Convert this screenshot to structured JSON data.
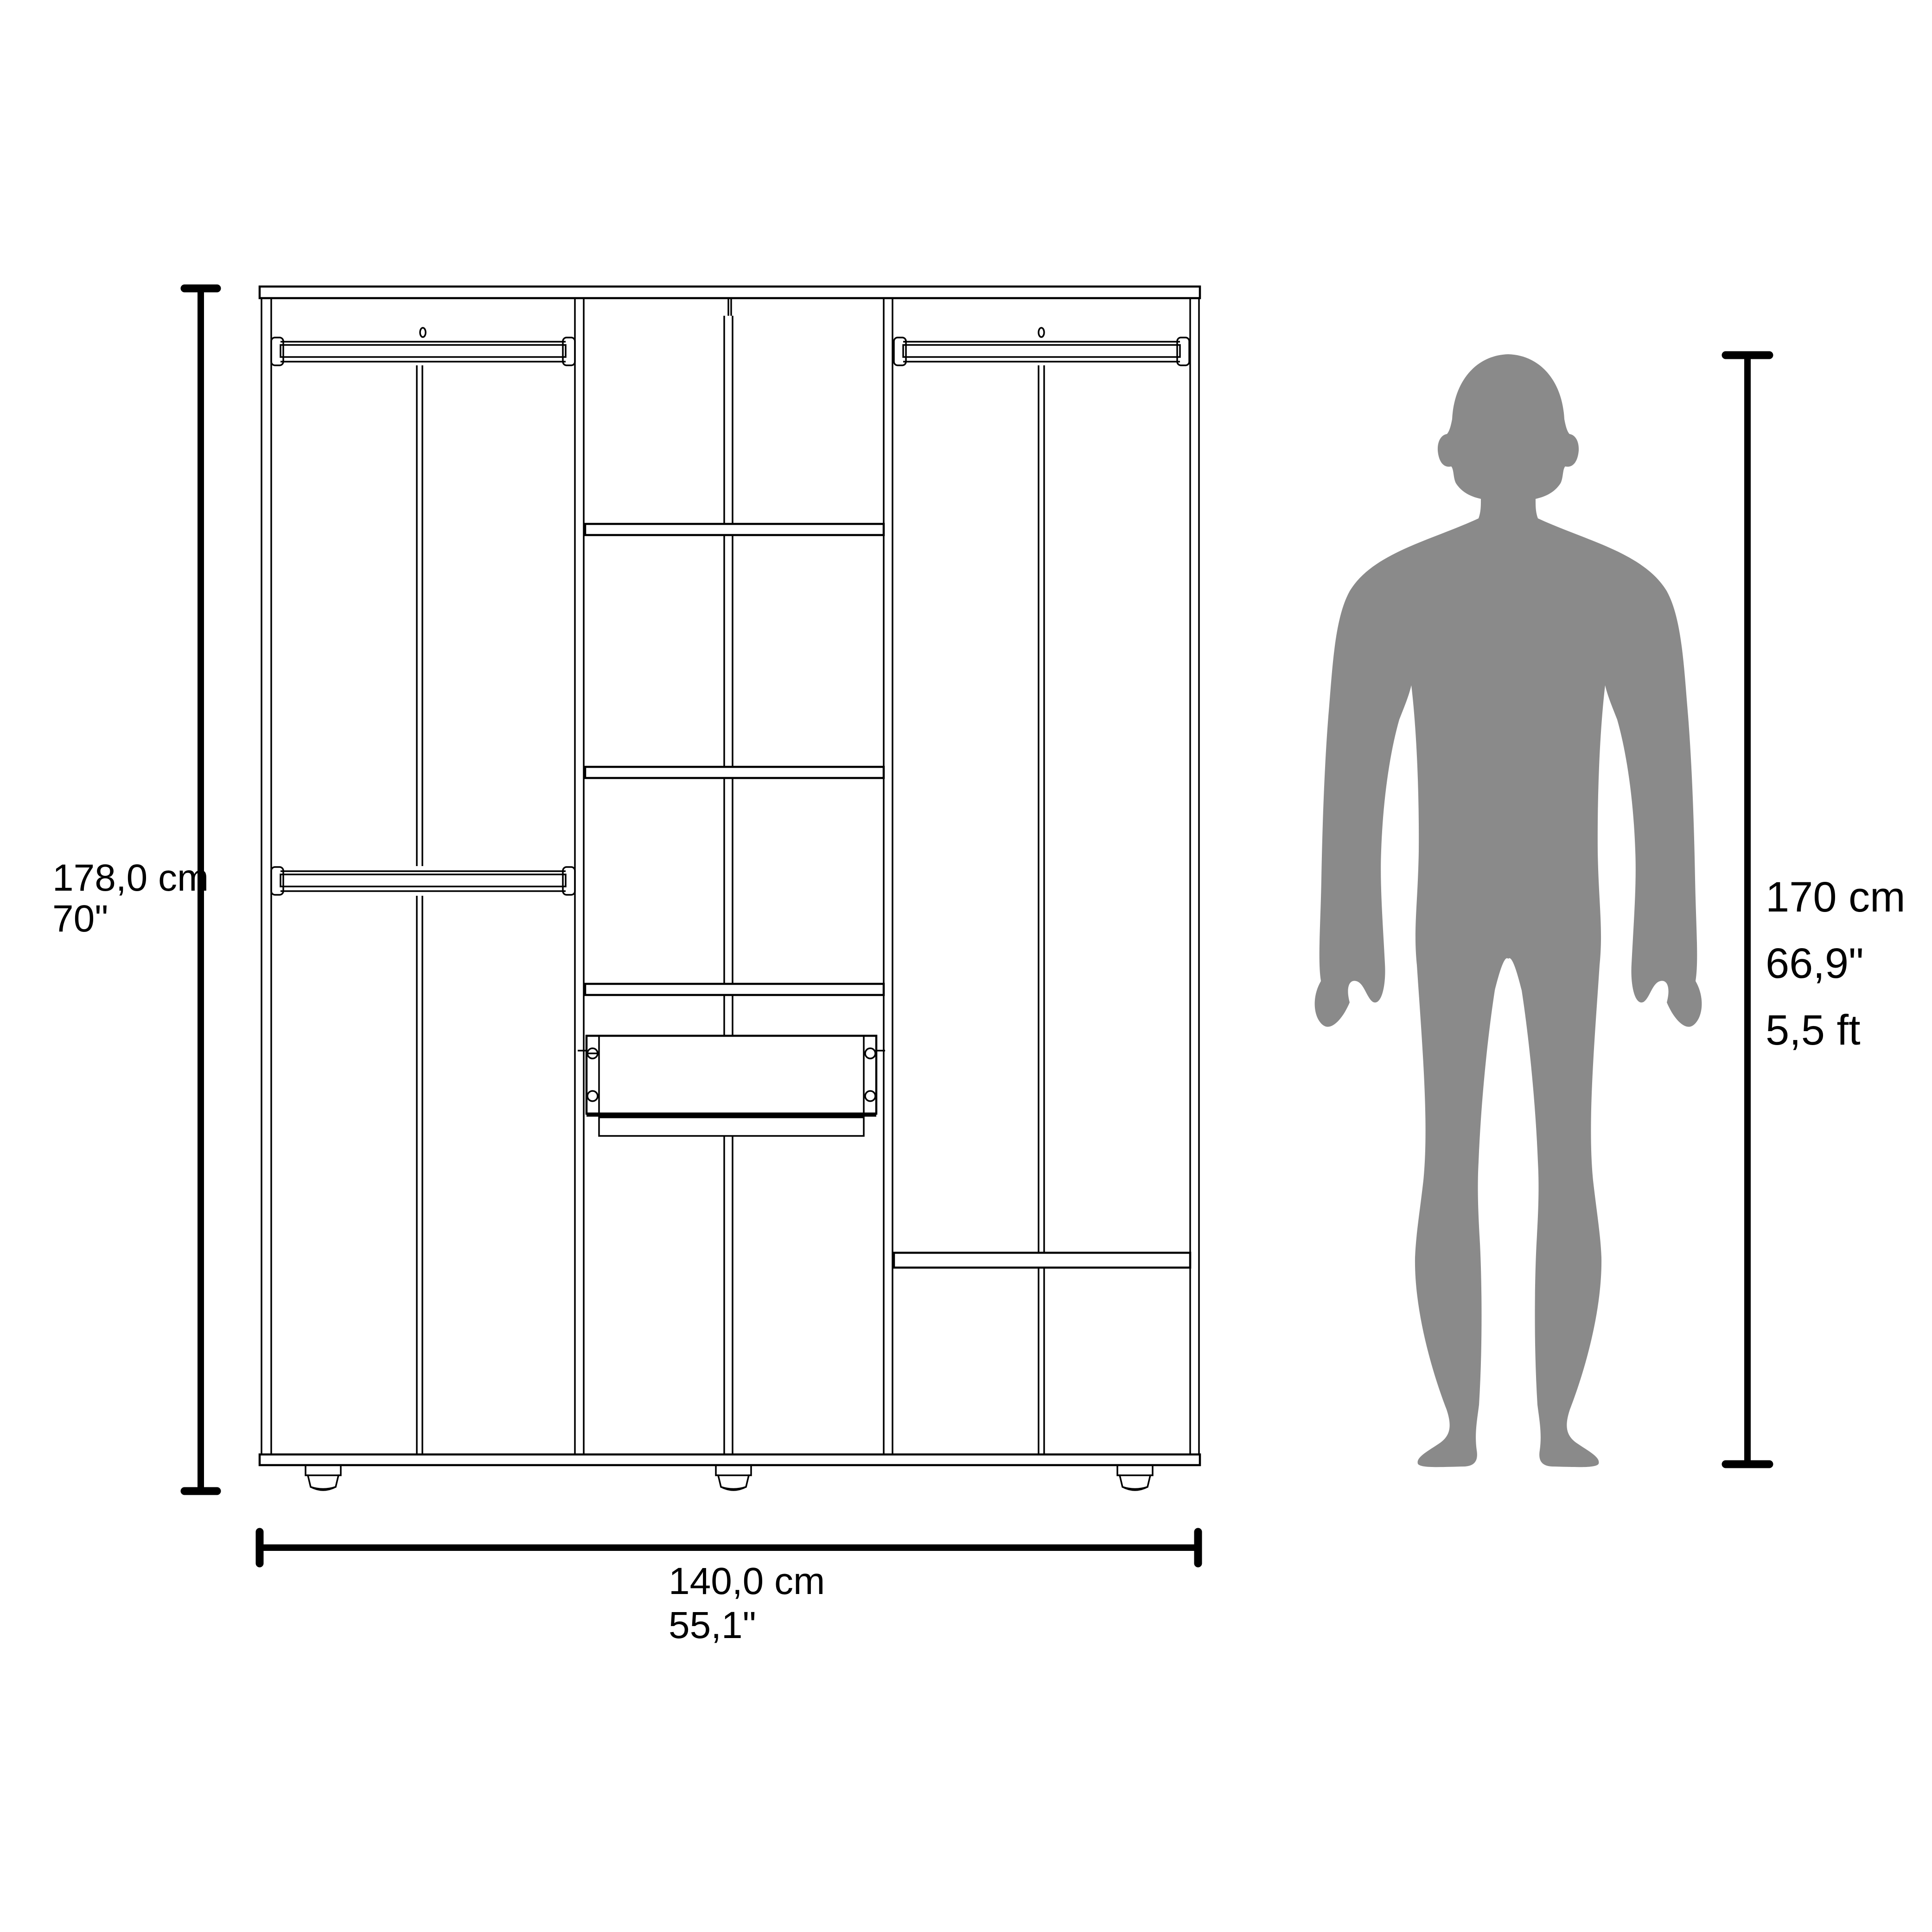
{
  "labels": {
    "product_height_cm": "178,0 cm",
    "product_height_in": "70\"",
    "product_width_cm": "140,0 cm",
    "product_width_in": "55,1\"",
    "person_height_cm": "170 cm",
    "person_height_in": "66,9\"",
    "person_height_ft": "5,5 ft"
  },
  "colors": {
    "ink": "#000000",
    "silhouette": "#8a8a8a",
    "background": "#ffffff"
  }
}
